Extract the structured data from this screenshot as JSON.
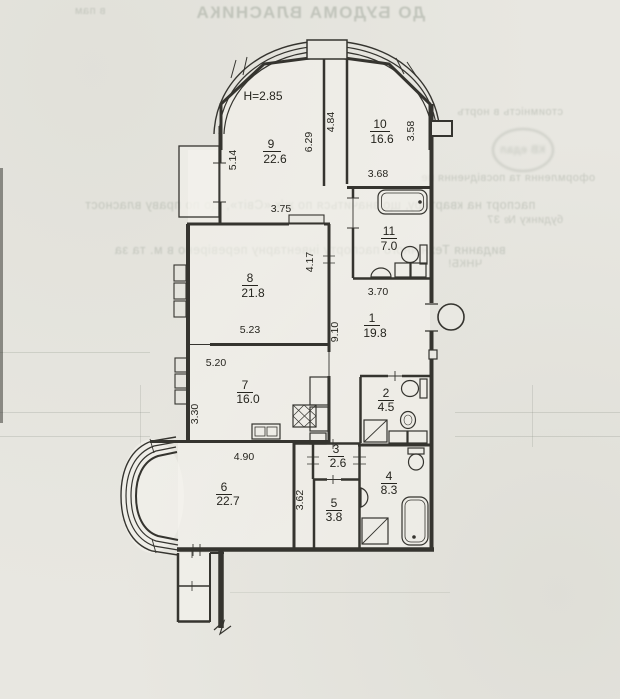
{
  "page": {
    "background_color": "#e8e7e1",
    "wall_color": "#35342f",
    "text_color": "#26251f"
  },
  "ghost_text": {
    "lines": [
      "ДО БУДОМА ВЛАСНИКА",
      "паспорт на квартиру, що значиться по ж/к «Світ», що по праву власност",
      "видання Технічного паспорту інвентарну перевірено в м. та за",
      "стоимність в нортъ",
      "оформлення та посвідчення пе",
      "будинку  № 37",
      "ЧНКБ!",
      "КВ едал",
      "в пам"
    ]
  },
  "plan": {
    "ceiling_height": "H=2.85",
    "rooms": [
      {
        "number": "1",
        "area": "19.8"
      },
      {
        "number": "2",
        "area": "4.5"
      },
      {
        "number": "3",
        "area": "2.6"
      },
      {
        "number": "4",
        "area": "8.3"
      },
      {
        "number": "5",
        "area": "3.8"
      },
      {
        "number": "6",
        "area": "22.7"
      },
      {
        "number": "7",
        "area": "16.0"
      },
      {
        "number": "8",
        "area": "21.8"
      },
      {
        "number": "9",
        "area": "22.6"
      },
      {
        "number": "10",
        "area": "16.6"
      },
      {
        "number": "11",
        "area": "7.0"
      }
    ],
    "dimensions": {
      "room9_left": "5.14",
      "room9_width": "3.75",
      "corridor_left": "6.29",
      "corridor_right": "4.84",
      "room10_right": "3.58",
      "room10_width": "3.68",
      "room8_right": "4.17",
      "room11_width": "3.70",
      "hall_height": "9.10",
      "room8_width": "5.23",
      "room7_top_width": "5.20",
      "room7_left": "3.30",
      "room6_width": "4.90",
      "room5_left": "3.62"
    }
  }
}
